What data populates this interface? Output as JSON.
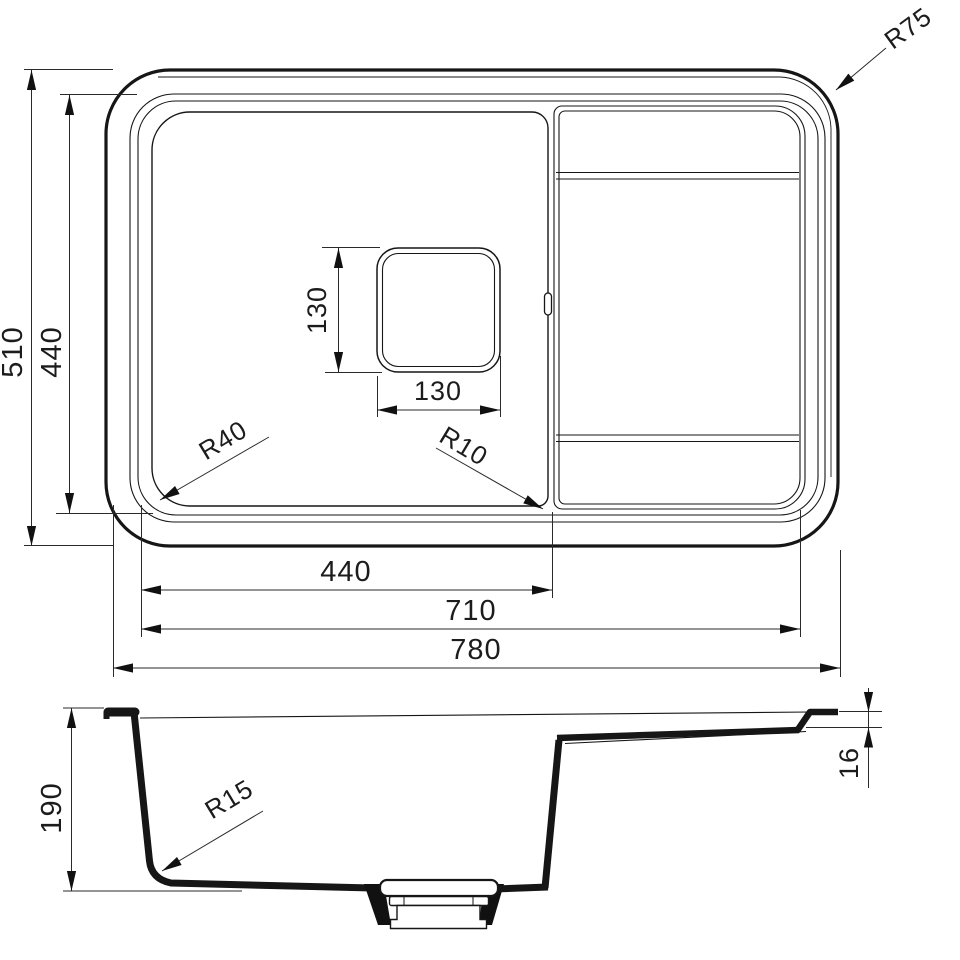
{
  "top_view": {
    "overall_depth": "510",
    "inner_depth": "440",
    "bowl_inner_width": "440",
    "inner_width": "710",
    "overall_width": "780",
    "drain_width": "130",
    "drain_height": "130",
    "radius_outer_corner": "R75",
    "radius_bowl_corner": "R40",
    "radius_bowl_corner_small": "R10"
  },
  "section_view": {
    "bowl_depth": "190",
    "rim_thickness": "16",
    "radius_bowl_bottom": "R15"
  }
}
